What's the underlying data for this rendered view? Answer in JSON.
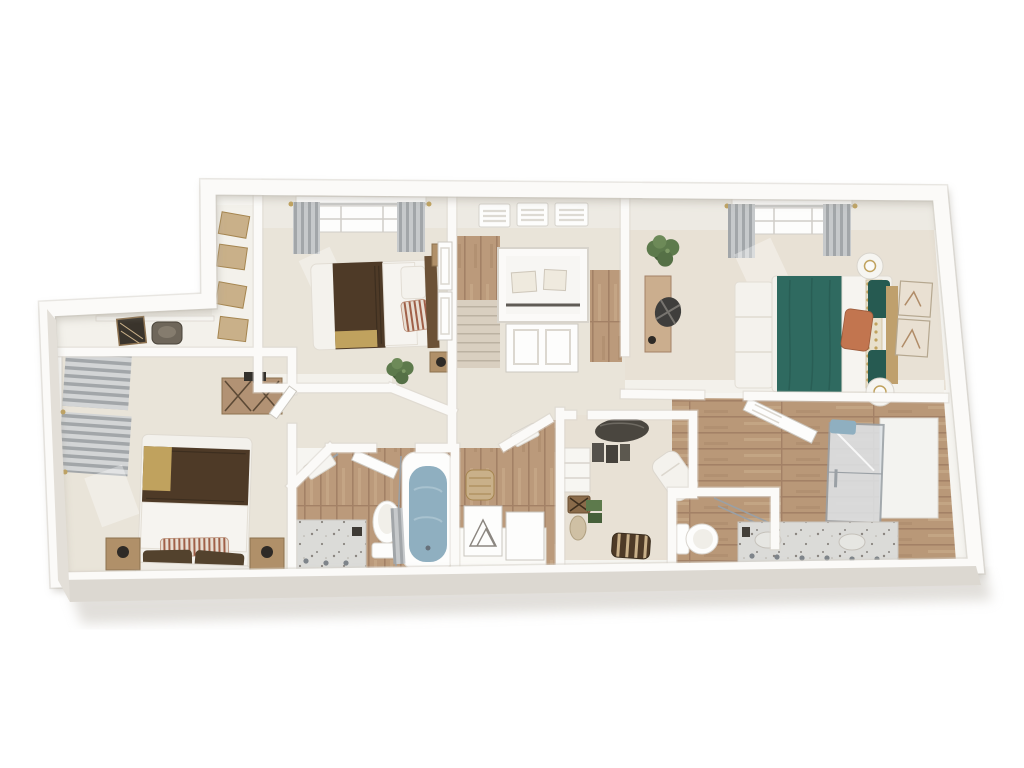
{
  "scene": {
    "type": "3d-floor-plan-render",
    "view": "overhead dollhouse perspective",
    "description": "Photoreal 3D rendering of a staged residential upper floor: three bedrooms, two full bathrooms, a water closet, walk-in closet, laundry/storage hall, stairwell and hallway. White walls, beige carpet, wood-look tile in wet areas.",
    "visible_text": ""
  },
  "palette": {
    "page_bg": "#ffffff",
    "wall": "#fbfaf8",
    "wall_edge": "#d8d4cc",
    "wall_inner": "#edeae3",
    "wall_inner2": "#f3f1eb",
    "floor_slab": "#f6f5f1",
    "carpet": "#e9e4d9",
    "carpet_warm": "#e8e1d5",
    "wood": "#bb9a7b",
    "wood_dark": "#a38166",
    "wood_light": "#cbae8e",
    "steps": "#d9cfc0",
    "marble": "#dbdbd8",
    "speck": "#8a8580",
    "white_soft": "#f4f2ed",
    "teal": "#2f6a60",
    "teal_dark": "#265a51",
    "orange": "#c2754f",
    "gold": "#c0a25e",
    "brown": "#4e3a27",
    "brown_dark": "#362a1c",
    "tan_box": "#c9b089",
    "curtain": "#b9bcbe",
    "curtain_dark": "#a2a6a9",
    "tub_water": "#8fafc0",
    "plant": "#5d7a4c",
    "plant_dark": "#46603a",
    "glass": "#dde2e6",
    "chrome": "#9aa0a5",
    "headboard_tan": "#bfa06d",
    "dark_wood": "#6b5136"
  },
  "rooms": [
    {
      "id": "bedroom-1",
      "kind": "bedroom",
      "floor": "carpet",
      "furniture": [
        "bed with brown throw and gold band",
        "striped pillows",
        "two dark wood nightstands with lamps",
        "potted plant",
        "double closet doors",
        "window with gray grommet curtains"
      ]
    },
    {
      "id": "master-bedroom",
      "kind": "bedroom",
      "floor": "carpet",
      "furniture": [
        "bed with teal coverlet and white duvet",
        "orange accent pillow",
        "patterned pillows",
        "white storage bench",
        "two round nightstands with lamps",
        "two framed art pieces",
        "wood desk with black chair",
        "potted plant",
        "window with gray curtains"
      ]
    },
    {
      "id": "bedroom-3",
      "kind": "bedroom",
      "floor": "carpet",
      "furniture": [
        "bed with brown blanket and gold corner",
        "striped lumbar pillow",
        "two wood nightstands with black lamps",
        "media dresser with X doors",
        "window with striped gray curtains"
      ]
    },
    {
      "id": "hall-landing",
      "kind": "hallway with stairwell",
      "floor": "carpet and wood",
      "furniture": [
        "staircase",
        "linen closet with cream boxes",
        "three clerestory windows with blinds"
      ]
    },
    {
      "id": "laundry-hall",
      "kind": "storage corridor",
      "floor": "pale",
      "furniture": [
        "dark suitcase",
        "woven chair",
        "shelving with four tan boxes"
      ]
    },
    {
      "id": "bathroom-1",
      "kind": "full bathroom",
      "floor": "wood tile",
      "furniture": [
        "marble vanity with faucets",
        "toilet",
        "tub with blue water and shower curtain",
        "towel bar"
      ]
    },
    {
      "id": "vanity-nook",
      "kind": "hall nook",
      "floor": "wood tile",
      "furniture": [
        "woven hamper",
        "white counter",
        "two leaning frames",
        "hand towel"
      ]
    },
    {
      "id": "walk-in-closet",
      "kind": "closet",
      "floor": "carpet",
      "furniture": [
        "hanging clothes",
        "white cubbies",
        "luggage rack",
        "white chaise",
        "striped ottoman"
      ]
    },
    {
      "id": "water-closet",
      "kind": "toilet room",
      "floor": "wood tile",
      "furniture": [
        "toilet",
        "hanging rods"
      ]
    },
    {
      "id": "master-bathroom",
      "kind": "full bathroom",
      "floor": "wood tile",
      "furniture": [
        "open door",
        "glass shower with blue towel",
        "marble double vanity with faucets"
      ]
    }
  ]
}
